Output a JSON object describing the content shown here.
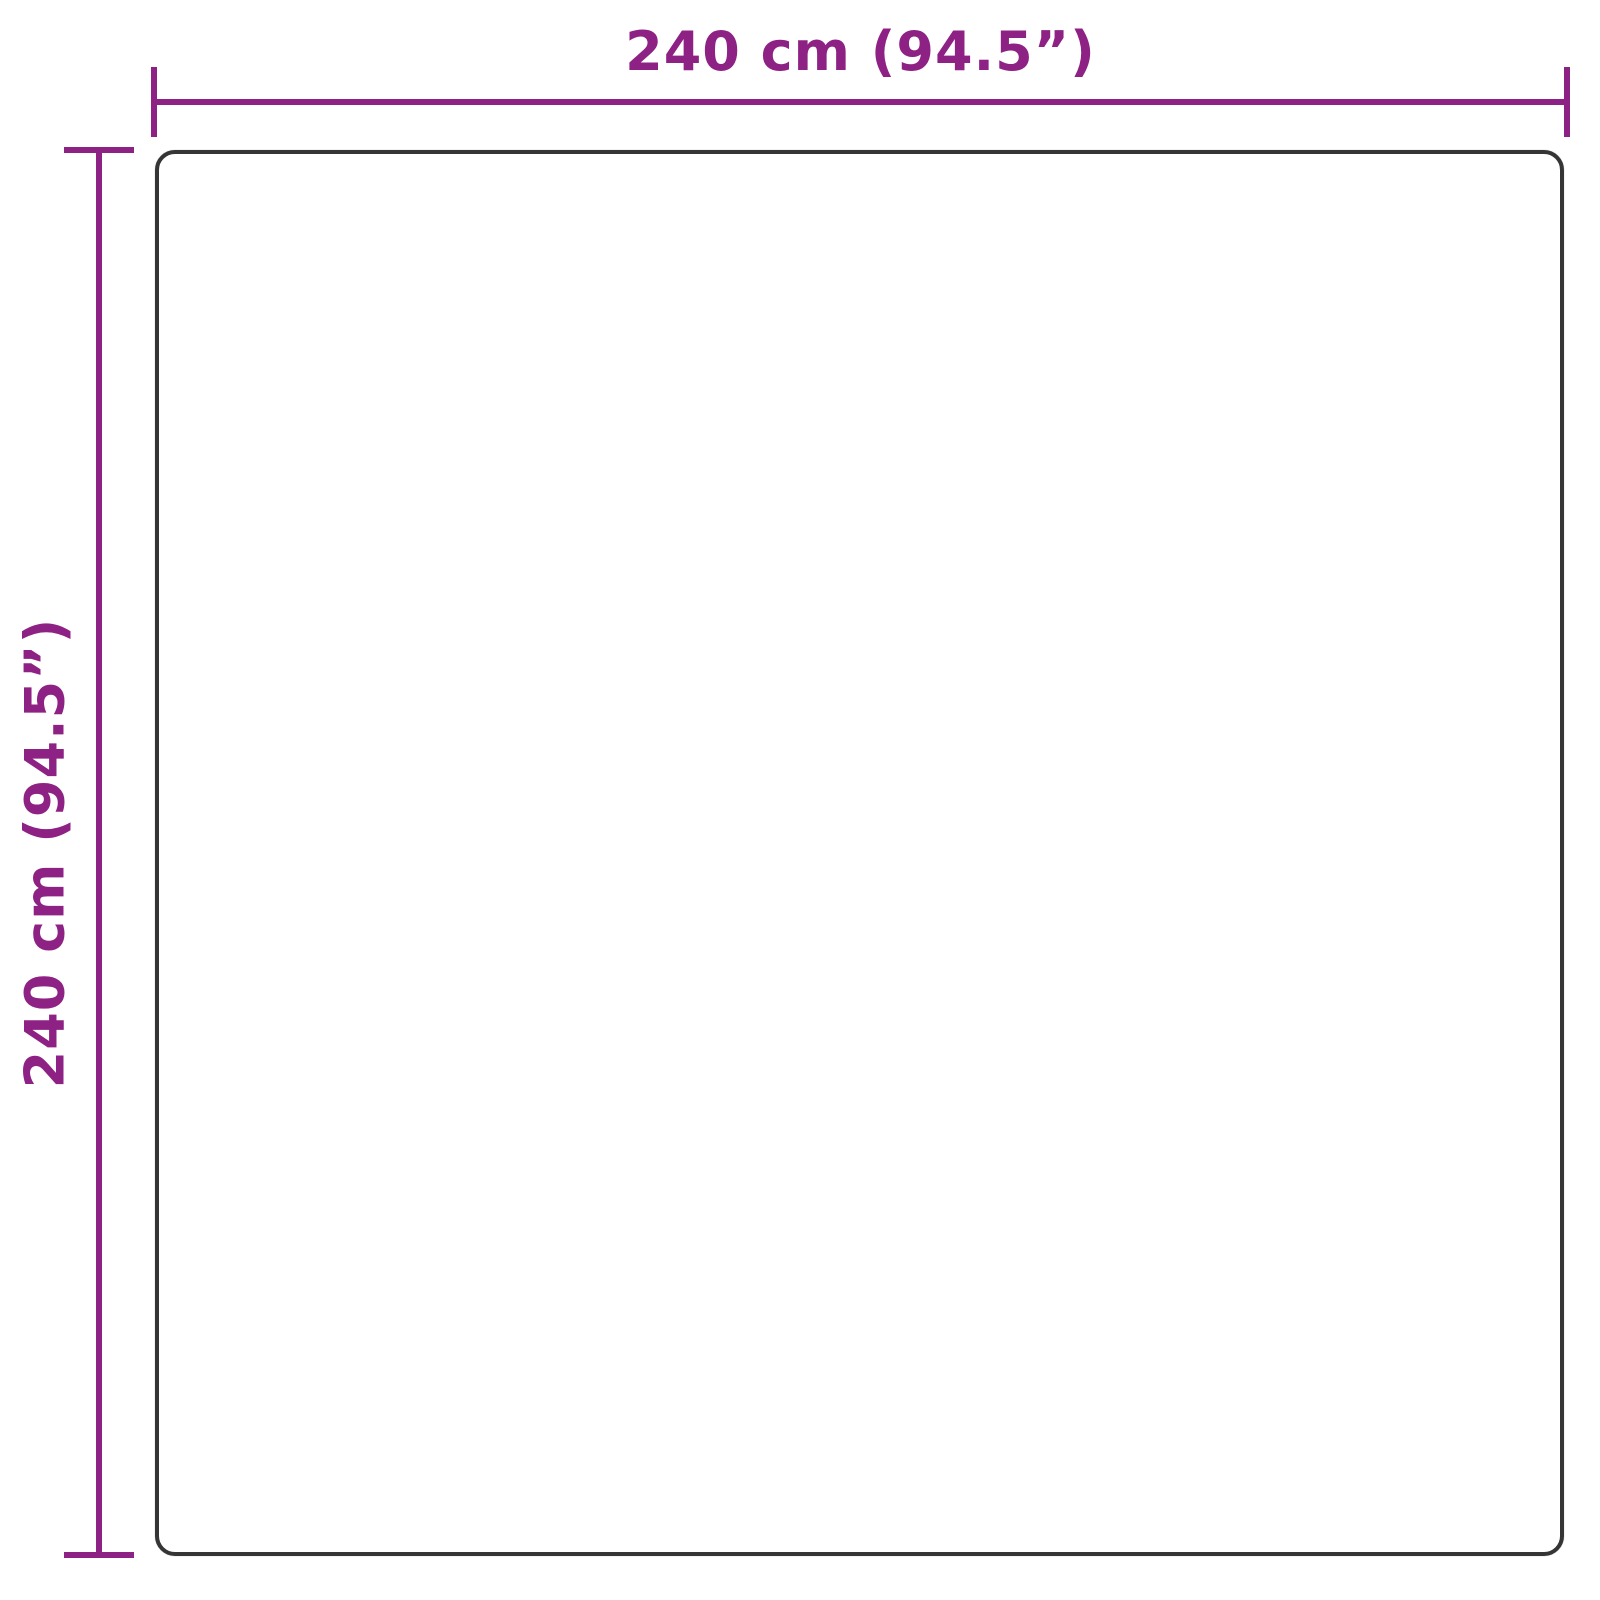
{
  "diagram": {
    "type": "product-dimension-diagram",
    "shape": "square-outline"
  },
  "dimensions": {
    "width": {
      "label": "240 cm (94.5”)",
      "value_cm": 240,
      "value_inches": 94.5
    },
    "height": {
      "label": "240 cm (94.5”)",
      "value_cm": 240,
      "value_inches": 94.5
    }
  },
  "colors": {
    "dimension_accent": "#8E2184",
    "outline_stroke": "#353535",
    "background": "#FFFFFF"
  }
}
